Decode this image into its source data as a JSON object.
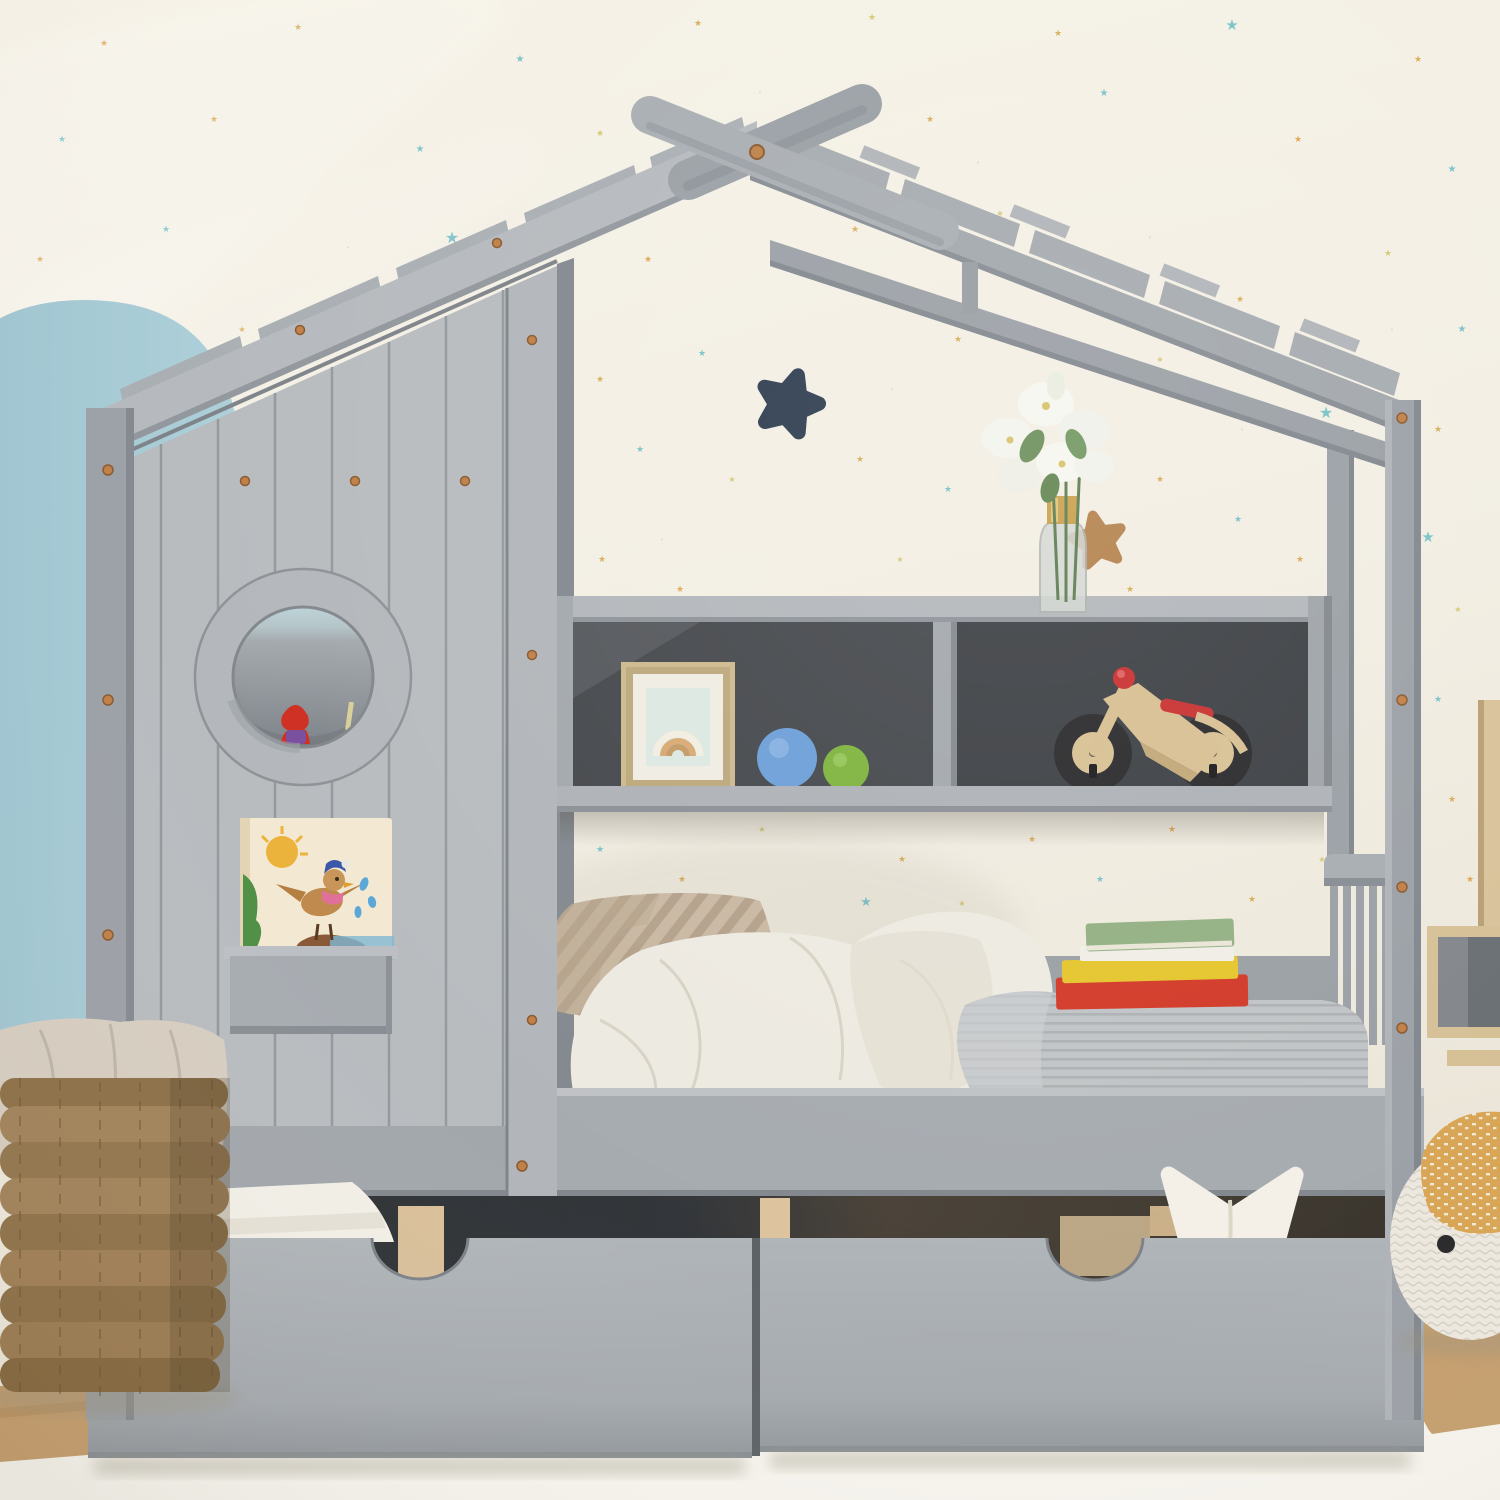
{
  "scene": {
    "description": "kids house-frame daybed product photo",
    "room": "children bedroom with star wallpaper"
  },
  "palette": {
    "wall": "#f2eee3",
    "wall_light": "#f7f4ea",
    "arch": "#a7cbd5",
    "frame": "#9ca1a7",
    "frame_light": "#b6babe",
    "frame_mid": "#a8adb2",
    "frame_dark": "#878d93",
    "plank": "#b8bcbf",
    "seam": "#94999d",
    "shelf_back": "#45484c",
    "shelf_back_dark": "#3a3d41",
    "drawer": "#a8adb2",
    "gap": "#313437",
    "wood": "#d9c09a",
    "wood_floor": "#c59e6d",
    "copper": "#c08048",
    "navy_star": "#2e3d4f",
    "tan_star": "#b5834e",
    "ball_blue": "#6d9fd8",
    "ball_green": "#7fb43e",
    "bike_wood": "#d8bf92",
    "bike_red": "#c93030",
    "tire": "#2a2a2c",
    "frame_gold": "#cdb98e",
    "art_bg": "#dce8e2",
    "vase_gold": "#c8a14e",
    "leaf": "#6c8f5c",
    "flower": "#f4f4ee",
    "pillow": "#c9b8a2",
    "duvet": "#edeae1",
    "blanket": "#c0c3c5",
    "book_red": "#d23a28",
    "book_yellow": "#e5c62e",
    "book_white": "#f0eee6",
    "book_green": "#93b083",
    "star_pillow": "#f4f0e8",
    "basket": "#a2835a",
    "liner": "#d7cec1",
    "pouf": "#ece8df",
    "mustard": "#d9a657",
    "rug": "#f6f4ed",
    "window_blue": "#bcd3d8"
  },
  "star_colors": {
    "g": "#d2a342",
    "t": "#66bac3",
    "o": "#de9a3c",
    "y": "#cdc25e",
    "d": "#e2d8ba"
  },
  "stars": [
    [
      104,
      46,
      9,
      "o"
    ],
    [
      298,
      30,
      9,
      "g"
    ],
    [
      520,
      62,
      10,
      "t"
    ],
    [
      698,
      26,
      9,
      "g"
    ],
    [
      872,
      20,
      9,
      "y"
    ],
    [
      1058,
      36,
      9,
      "g"
    ],
    [
      1232,
      30,
      15,
      "t"
    ],
    [
      1418,
      62,
      9,
      "g"
    ],
    [
      62,
      142,
      9,
      "t"
    ],
    [
      214,
      122,
      9,
      "g"
    ],
    [
      420,
      152,
      10,
      "t"
    ],
    [
      600,
      136,
      9,
      "y"
    ],
    [
      760,
      95,
      7,
      "d"
    ],
    [
      930,
      122,
      9,
      "g"
    ],
    [
      1104,
      96,
      10,
      "t"
    ],
    [
      1298,
      142,
      9,
      "o"
    ],
    [
      1452,
      172,
      10,
      "t"
    ],
    [
      40,
      262,
      9,
      "g"
    ],
    [
      166,
      232,
      9,
      "t"
    ],
    [
      452,
      243,
      16,
      "t"
    ],
    [
      560,
      302,
      9,
      "y"
    ],
    [
      648,
      262,
      9,
      "o"
    ],
    [
      855,
      232,
      9,
      "g"
    ],
    [
      1000,
      216,
      8,
      "y"
    ],
    [
      1094,
      273,
      16,
      "t"
    ],
    [
      1240,
      302,
      9,
      "g"
    ],
    [
      1388,
      256,
      9,
      "y"
    ],
    [
      1462,
      332,
      10,
      "t"
    ],
    [
      82,
      352,
      9,
      "o"
    ],
    [
      242,
      332,
      8,
      "g"
    ],
    [
      362,
      392,
      9,
      "o"
    ],
    [
      600,
      382,
      9,
      "g"
    ],
    [
      702,
      356,
      9,
      "t"
    ],
    [
      958,
      342,
      9,
      "g"
    ],
    [
      1060,
      392,
      9,
      "o"
    ],
    [
      1160,
      362,
      8,
      "y"
    ],
    [
      1326,
      418,
      16,
      "t"
    ],
    [
      1438,
      432,
      9,
      "g"
    ],
    [
      640,
      452,
      9,
      "t"
    ],
    [
      732,
      482,
      8,
      "y"
    ],
    [
      860,
      462,
      9,
      "g"
    ],
    [
      948,
      492,
      9,
      "t"
    ],
    [
      1160,
      482,
      9,
      "g"
    ],
    [
      1238,
      522,
      9,
      "t"
    ],
    [
      1428,
      542,
      15,
      "t"
    ],
    [
      602,
      562,
      9,
      "g"
    ],
    [
      680,
      592,
      9,
      "o"
    ],
    [
      900,
      562,
      8,
      "y"
    ],
    [
      1130,
      592,
      9,
      "g"
    ],
    [
      1300,
      562,
      9,
      "o"
    ],
    [
      1458,
      612,
      8,
      "y"
    ],
    [
      586,
      642,
      8,
      "y"
    ],
    [
      812,
      648,
      15,
      "t"
    ],
    [
      880,
      702,
      9,
      "g"
    ],
    [
      1345,
      652,
      9,
      "g"
    ],
    [
      1438,
      702,
      9,
      "t"
    ],
    [
      1348,
      730,
      8,
      "y"
    ],
    [
      600,
      852,
      9,
      "t"
    ],
    [
      682,
      882,
      9,
      "g"
    ],
    [
      762,
      832,
      8,
      "y"
    ],
    [
      866,
      906,
      13,
      "t"
    ],
    [
      902,
      862,
      9,
      "g"
    ],
    [
      962,
      906,
      8,
      "y"
    ],
    [
      1032,
      842,
      9,
      "g"
    ],
    [
      1100,
      882,
      9,
      "t"
    ],
    [
      1172,
      832,
      9,
      "o"
    ],
    [
      1252,
      902,
      9,
      "g"
    ],
    [
      1322,
      862,
      8,
      "y"
    ],
    [
      702,
      942,
      9,
      "o"
    ],
    [
      1002,
      952,
      9,
      "g"
    ],
    [
      1452,
      802,
      9,
      "g"
    ],
    [
      1470,
      882,
      9,
      "o"
    ],
    [
      1462,
      1062,
      9,
      "t"
    ],
    [
      348,
      250,
      7,
      "d"
    ],
    [
      1150,
      240,
      7,
      "d"
    ],
    [
      500,
      422,
      7,
      "d"
    ],
    [
      1242,
      432,
      7,
      "d"
    ],
    [
      892,
      392,
      7,
      "d"
    ],
    [
      662,
      542,
      7,
      "d"
    ],
    [
      1392,
      332,
      7,
      "d"
    ],
    [
      978,
      165,
      7,
      "d"
    ],
    [
      770,
      142,
      7,
      "d"
    ],
    [
      905,
      795,
      7,
      "d"
    ],
    [
      1230,
      770,
      7,
      "d"
    ]
  ],
  "objects": {
    "bed": "gray wooden house bed with roof, round window wall, bookcase and two storage drawers",
    "shelf_items": [
      "rainbow art in gold frame",
      "blue ball",
      "green ball",
      "wooden balance bike"
    ],
    "top_of_shelf": [
      "glass vase with white lilies"
    ],
    "wall_decor": [
      "navy plush star",
      "tan wooden star"
    ],
    "bedding": [
      "beige striped pillows",
      "white duvet",
      "gray striped blanket",
      "stack of books"
    ],
    "books_on_bed": [
      "#93b083",
      "#f0eee6",
      "#e5c62e",
      "#d23a28"
    ],
    "floor_items_left": [
      "wicker basket with fabric liner"
    ],
    "floor_items_right": [
      "wood wall shelf",
      "knit pouf with mustard blanket"
    ],
    "drawer_details": [
      "half-moon cutout handles",
      "white star pillow peeking out",
      "white wedge pillow"
    ]
  }
}
